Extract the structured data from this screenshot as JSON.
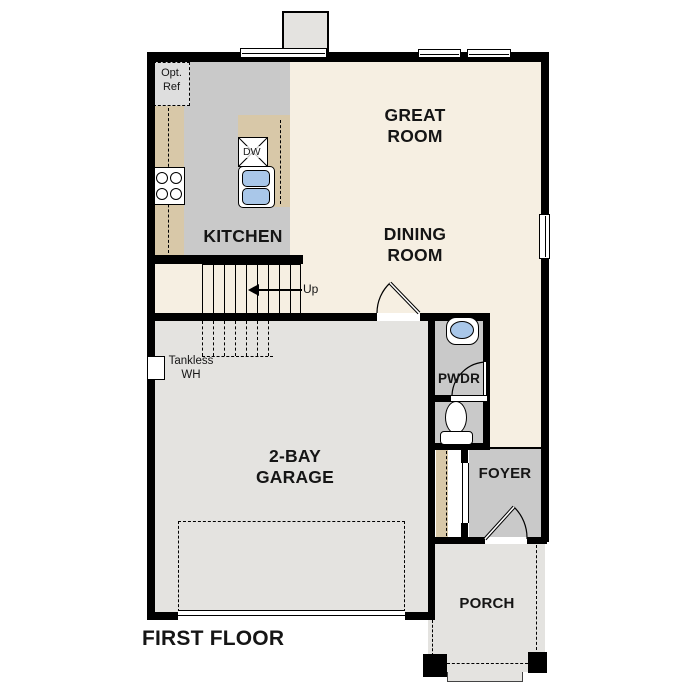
{
  "floor_plan": {
    "title": "FIRST FLOOR",
    "rooms": {
      "great_room": {
        "label": "GREAT\nROOM"
      },
      "dining_room": {
        "label": "DINING\nROOM"
      },
      "kitchen": {
        "label": "KITCHEN"
      },
      "garage": {
        "label": "2-BAY\nGARAGE"
      },
      "powder_room": {
        "label": "PWDR"
      },
      "foyer": {
        "label": "FOYER"
      },
      "porch": {
        "label": "PORCH"
      }
    },
    "annotations": {
      "optional_refrigerator": "Opt.\nRef",
      "dishwasher": "DW",
      "tankless_water_heater": "Tankless\nWH",
      "stairs_direction": "Up"
    },
    "colors": {
      "wall": "#000000",
      "floor_living": "#f6efe2",
      "floor_kitchen": "#c9c9c9",
      "floor_garage": "#e4e3e0",
      "counter": "#d8c8a8",
      "water": "#a9c7e9",
      "optional_box": "#dedede",
      "background": "#ffffff"
    }
  }
}
